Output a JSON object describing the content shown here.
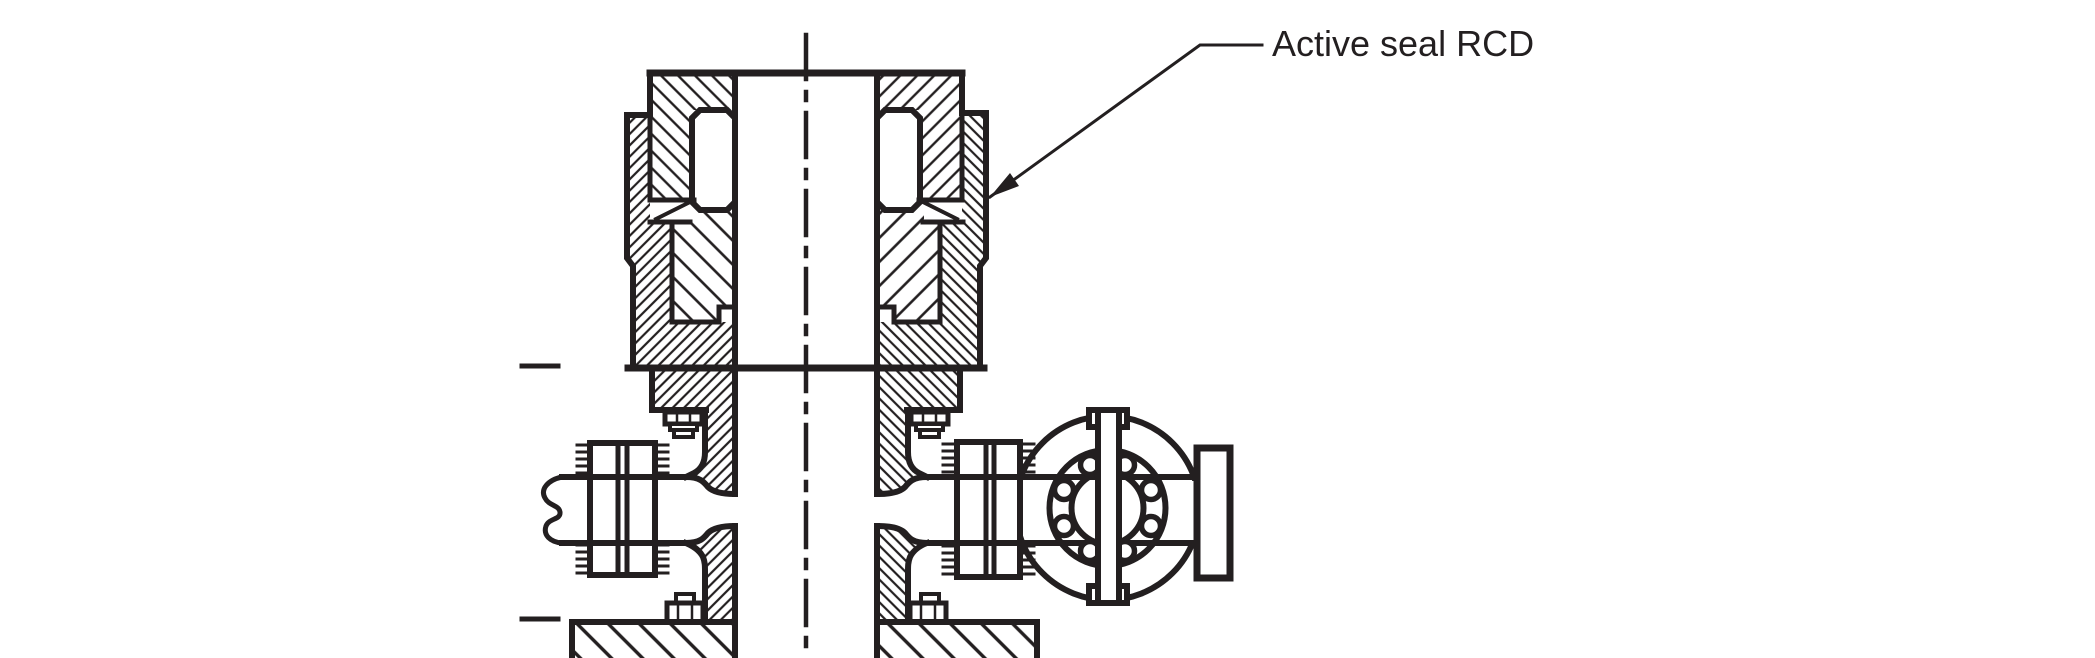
{
  "drawing": {
    "kind": "engineering cross-section diagram",
    "annotation": {
      "label": "Active seal RCD",
      "leader": "polyline from label to arrowhead touching the upper housing outer wall"
    }
  },
  "colors": {
    "ink": "#231f20",
    "background": "#ffffff"
  }
}
